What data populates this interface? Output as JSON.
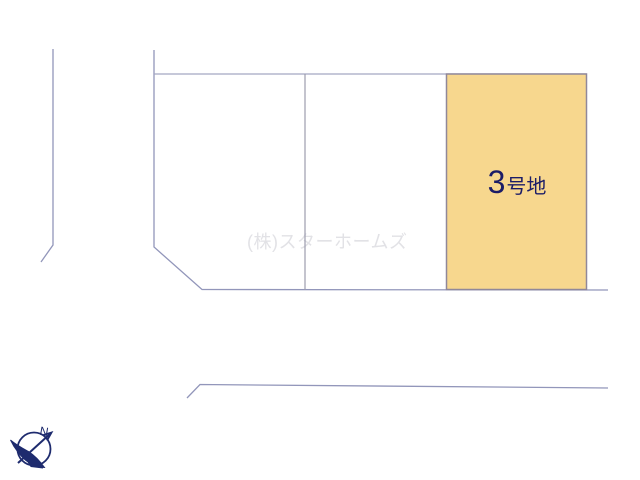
{
  "site_plan": {
    "highlighted_lot": {
      "number": "3",
      "suffix": "号地",
      "label": "3号地",
      "fill_color": "#f7d78e",
      "border_color": "#90889a",
      "label_color": "#1b1c67"
    },
    "watermark": {
      "text": "(株)スターホームズ",
      "color": "#e2e2e6"
    },
    "boundary_line_color": "#9296ba"
  },
  "compass": {
    "north_label": "N",
    "color": "#1e2b6e"
  }
}
